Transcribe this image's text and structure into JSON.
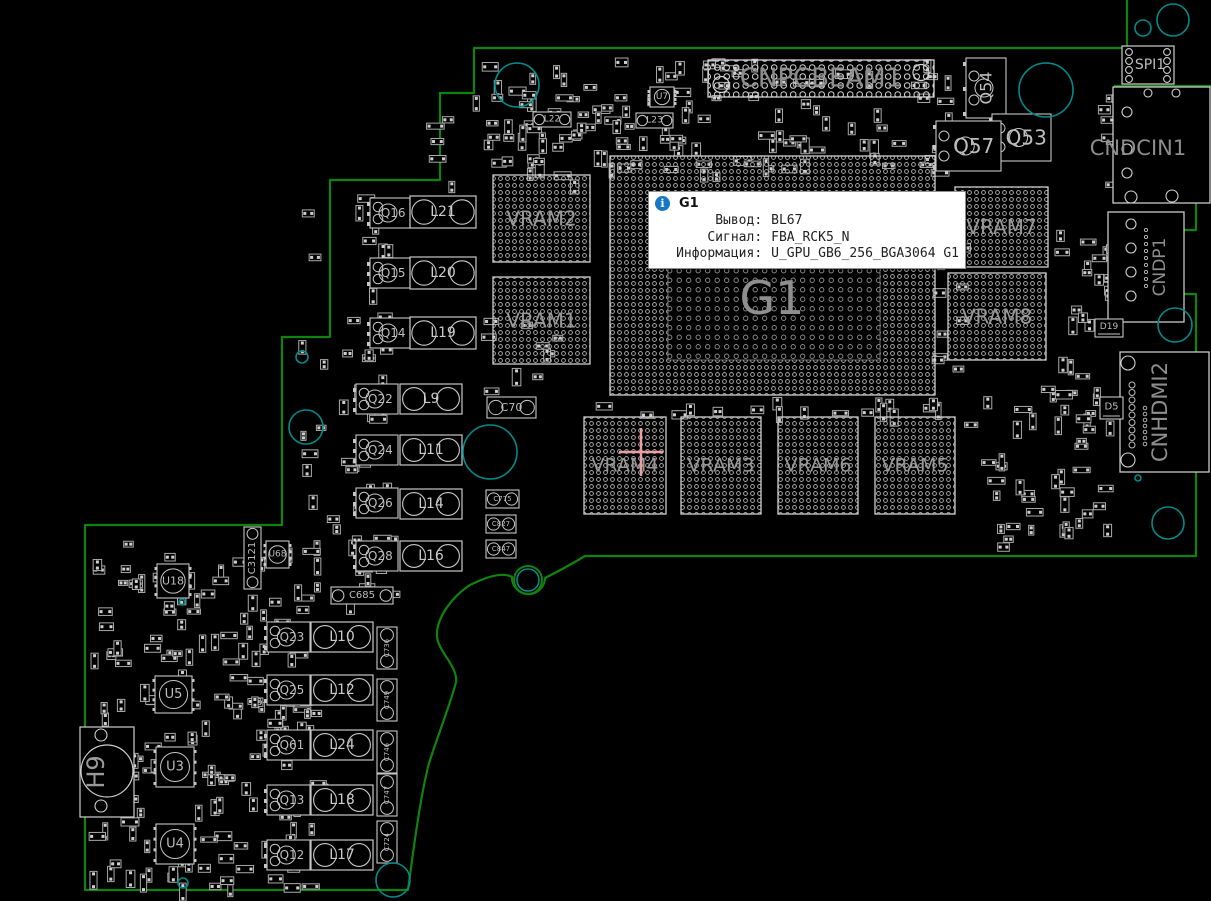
{
  "colors": {
    "background": "#000000",
    "board_outline": "#0e840e",
    "mounting_hole": "#008b8b",
    "component_stroke": "#c6c6c6",
    "pad_dot": "#bdbdbd",
    "label_big": "#8a8a8a",
    "label_small": "#bdbdbd",
    "crosshair": "#e8a0a0",
    "tooltip_icon_bg": "#1777c4"
  },
  "tooltip": {
    "title": "G1",
    "icon": "info-icon",
    "rows": [
      {
        "label": "Вывод:",
        "value": "BL67"
      },
      {
        "label": "Сигнал:",
        "value": "FBA_RCK5_N"
      },
      {
        "label": "Информация:",
        "value": "U_GPU_GB6_256_BGA3064 G1"
      }
    ]
  },
  "crosshair": {
    "x": 641,
    "y": 452,
    "arm_h": 22,
    "arm_v": 24
  },
  "board": {
    "outline_path": "M1127,0 L1127,48 L474,48 L474,93 L440,93 L440,180 L330,180 L330,337 L282,337 L282,525 L85,525 L85,890 L408,890 C414,845 420,800 428,767 C433,748 452,700 456,682 C458,666 438,652 437,636 C436,620 450,598 470,585 Q500,570 512,577 A15,15 0 1 0 545,578 Q565,568 585,556 L1196,556 L1196,294 L1150,294 L1150,230 L1196,230 L1196,186 L1115,186 L1115,86 L1211,86",
    "hdmi_cutout": {
      "x": 1141,
      "y": 357,
      "w": 33,
      "h": 112,
      "rx": 9
    },
    "edge_notch_circle": {
      "x": 528,
      "y": 580,
      "r": 14
    }
  },
  "holes": [
    {
      "x": 517,
      "y": 85,
      "r": 22
    },
    {
      "x": 1046,
      "y": 90,
      "r": 27
    },
    {
      "x": 1173,
      "y": 20,
      "r": 16
    },
    {
      "x": 1143,
      "y": 28,
      "r": 8
    },
    {
      "x": 490,
      "y": 452,
      "r": 27
    },
    {
      "x": 306,
      "y": 427,
      "r": 17
    },
    {
      "x": 302,
      "y": 357,
      "r": 6
    },
    {
      "x": 528,
      "y": 580,
      "r": 11
    },
    {
      "x": 393,
      "y": 880,
      "r": 17
    },
    {
      "x": 1175,
      "y": 325,
      "r": 17
    },
    {
      "x": 1168,
      "y": 523,
      "r": 16
    },
    {
      "x": 183,
      "y": 883,
      "r": 5
    },
    {
      "x": 182,
      "y": 602,
      "r": 3
    },
    {
      "x": 1138,
      "y": 478,
      "r": 3
    }
  ],
  "components": [
    {
      "ref": "G1",
      "type": "bga",
      "x": 610,
      "y": 156,
      "w": 325,
      "h": 239,
      "ls": 46,
      "inner": true
    },
    {
      "ref": "VRAM2",
      "type": "bga",
      "x": 493,
      "y": 175,
      "w": 97,
      "h": 87,
      "ls": 20
    },
    {
      "ref": "VRAM1",
      "type": "bga",
      "x": 493,
      "y": 277,
      "w": 97,
      "h": 87,
      "ls": 20
    },
    {
      "ref": "VRAM7",
      "type": "bga",
      "x": 955,
      "y": 187,
      "w": 93,
      "h": 80,
      "ls": 20
    },
    {
      "ref": "VRAM8",
      "type": "bga",
      "x": 948,
      "y": 273,
      "w": 98,
      "h": 87,
      "ls": 20
    },
    {
      "ref": "VRAM4",
      "type": "bga",
      "x": 584,
      "y": 417,
      "w": 82,
      "h": 97,
      "ls": 19
    },
    {
      "ref": "VRAM3",
      "type": "bga",
      "x": 681,
      "y": 417,
      "w": 80,
      "h": 97,
      "ls": 19
    },
    {
      "ref": "VRAM6",
      "type": "bga",
      "x": 778,
      "y": 417,
      "w": 80,
      "h": 97,
      "ls": 19
    },
    {
      "ref": "VRAM5",
      "type": "bga",
      "x": 875,
      "y": 417,
      "w": 80,
      "h": 97,
      "ls": 19
    },
    {
      "ref": "CNPCBEAM1",
      "type": "conn_grid",
      "x": 708,
      "y": 60,
      "w": 226,
      "h": 37,
      "ls": 26
    },
    {
      "ref": "SPI1",
      "type": "chip_pins",
      "x": 1122,
      "y": 46,
      "w": 52,
      "h": 38,
      "ls": 14
    },
    {
      "ref": "CNDCIN1",
      "type": "conn_edge",
      "x": 1113,
      "y": 87,
      "w": 97,
      "h": 116,
      "ls": 21,
      "lx": 1138,
      "ly": 148
    },
    {
      "ref": "CNDP1",
      "type": "conn_edge",
      "x": 1108,
      "y": 212,
      "w": 76,
      "h": 110,
      "ls": 17,
      "rot": true,
      "lx": 1160,
      "ly": 267
    },
    {
      "ref": "CNHDMI2",
      "type": "conn_edge",
      "x": 1120,
      "y": 352,
      "w": 89,
      "h": 120,
      "ls": 21,
      "rot": true,
      "lx": 1160,
      "ly": 412
    },
    {
      "ref": "H9",
      "type": "header",
      "x": 80,
      "y": 727,
      "w": 54,
      "h": 90,
      "ls": 24,
      "rot": true,
      "lx": 96,
      "ly": 772
    },
    {
      "ref": "Q16",
      "type": "mosfet",
      "x": 370,
      "y": 198,
      "w": 40,
      "h": 30,
      "ls": 12
    },
    {
      "ref": "L21",
      "type": "inductor",
      "x": 410,
      "y": 196,
      "w": 66,
      "h": 32,
      "ls": 14
    },
    {
      "ref": "Q15",
      "type": "mosfet",
      "x": 370,
      "y": 258,
      "w": 40,
      "h": 30,
      "ls": 12
    },
    {
      "ref": "L20",
      "type": "inductor",
      "x": 410,
      "y": 257,
      "w": 66,
      "h": 32,
      "ls": 14
    },
    {
      "ref": "Q14",
      "type": "mosfet",
      "x": 370,
      "y": 318,
      "w": 40,
      "h": 30,
      "ls": 12
    },
    {
      "ref": "L19",
      "type": "inductor",
      "x": 410,
      "y": 317,
      "w": 66,
      "h": 32,
      "ls": 14
    },
    {
      "ref": "Q22",
      "type": "mosfet",
      "x": 356,
      "y": 384,
      "w": 42,
      "h": 30,
      "ls": 12
    },
    {
      "ref": "L9",
      "type": "inductor",
      "x": 400,
      "y": 384,
      "w": 62,
      "h": 30,
      "ls": 14
    },
    {
      "ref": "Q24",
      "type": "mosfet",
      "x": 356,
      "y": 435,
      "w": 42,
      "h": 30,
      "ls": 12
    },
    {
      "ref": "L11",
      "type": "inductor",
      "x": 400,
      "y": 435,
      "w": 62,
      "h": 30,
      "ls": 14
    },
    {
      "ref": "Q26",
      "type": "mosfet",
      "x": 356,
      "y": 488,
      "w": 42,
      "h": 30,
      "ls": 12
    },
    {
      "ref": "L14",
      "type": "inductor",
      "x": 400,
      "y": 489,
      "w": 62,
      "h": 30,
      "ls": 14
    },
    {
      "ref": "Q28",
      "type": "mosfet",
      "x": 356,
      "y": 541,
      "w": 42,
      "h": 30,
      "ls": 12
    },
    {
      "ref": "L16",
      "type": "inductor",
      "x": 400,
      "y": 541,
      "w": 62,
      "h": 30,
      "ls": 14
    },
    {
      "ref": "Q23",
      "type": "mosfet",
      "x": 267,
      "y": 622,
      "w": 43,
      "h": 30,
      "ls": 12
    },
    {
      "ref": "L10",
      "type": "inductor",
      "x": 311,
      "y": 622,
      "w": 62,
      "h": 30,
      "ls": 14
    },
    {
      "ref": "Q25",
      "type": "mosfet",
      "x": 267,
      "y": 675,
      "w": 43,
      "h": 30,
      "ls": 12
    },
    {
      "ref": "L12",
      "type": "inductor",
      "x": 311,
      "y": 675,
      "w": 62,
      "h": 30,
      "ls": 14
    },
    {
      "ref": "Q61",
      "type": "mosfet",
      "x": 267,
      "y": 730,
      "w": 43,
      "h": 30,
      "ls": 12
    },
    {
      "ref": "L24",
      "type": "inductor",
      "x": 311,
      "y": 730,
      "w": 62,
      "h": 30,
      "ls": 14
    },
    {
      "ref": "Q13",
      "type": "mosfet",
      "x": 267,
      "y": 785,
      "w": 43,
      "h": 30,
      "ls": 12
    },
    {
      "ref": "L18",
      "type": "inductor",
      "x": 311,
      "y": 785,
      "w": 62,
      "h": 30,
      "ls": 14
    },
    {
      "ref": "Q12",
      "type": "mosfet",
      "x": 267,
      "y": 840,
      "w": 43,
      "h": 30,
      "ls": 12
    },
    {
      "ref": "L17",
      "type": "inductor",
      "x": 311,
      "y": 840,
      "w": 62,
      "h": 30,
      "ls": 14
    },
    {
      "ref": "Q54",
      "type": "mosfet",
      "x": 966,
      "y": 58,
      "w": 40,
      "h": 60,
      "ls": 16,
      "rot": true
    },
    {
      "ref": "Q53",
      "type": "mosfet",
      "x": 992,
      "y": 114,
      "w": 59,
      "h": 47,
      "ls": 20
    },
    {
      "ref": "Q57",
      "type": "mosfet",
      "x": 936,
      "y": 121,
      "w": 65,
      "h": 50,
      "ls": 20
    },
    {
      "ref": "U5",
      "type": "qfn",
      "x": 155,
      "y": 676,
      "w": 37,
      "h": 37,
      "ls": 13
    },
    {
      "ref": "U3",
      "type": "qfn",
      "x": 156,
      "y": 747,
      "w": 38,
      "h": 40,
      "ls": 13
    },
    {
      "ref": "U4",
      "type": "qfn",
      "x": 156,
      "y": 824,
      "w": 38,
      "h": 40,
      "ls": 13
    },
    {
      "ref": "U18",
      "type": "qfn",
      "x": 157,
      "y": 564,
      "w": 32,
      "h": 34,
      "ls": 11
    },
    {
      "ref": "U68",
      "type": "qfn",
      "x": 266,
      "y": 541,
      "w": 23,
      "h": 27,
      "ls": 9
    },
    {
      "ref": "U7",
      "type": "qfn",
      "x": 650,
      "y": 87,
      "w": 24,
      "h": 20,
      "ls": 9
    },
    {
      "ref": "C70",
      "type": "cap_h",
      "x": 487,
      "y": 397,
      "w": 49,
      "h": 21,
      "ls": 11
    },
    {
      "ref": "C685",
      "type": "cap_h",
      "x": 331,
      "y": 587,
      "w": 62,
      "h": 17,
      "ls": 10
    },
    {
      "ref": "L22",
      "type": "cap_h",
      "x": 533,
      "y": 112,
      "w": 38,
      "h": 15,
      "ls": 9
    },
    {
      "ref": "L23",
      "type": "cap_h",
      "x": 636,
      "y": 113,
      "w": 37,
      "h": 15,
      "ls": 9
    },
    {
      "ref": "C3121",
      "type": "cap_v",
      "x": 244,
      "y": 527,
      "w": 17,
      "h": 62,
      "ls": 10
    },
    {
      "ref": "C736",
      "type": "cap_v",
      "x": 377,
      "y": 627,
      "w": 20,
      "h": 42,
      "ls": 7
    },
    {
      "ref": "C749",
      "type": "cap_v",
      "x": 377,
      "y": 679,
      "w": 20,
      "h": 42,
      "ls": 7
    },
    {
      "ref": "C746",
      "type": "cap_v",
      "x": 377,
      "y": 731,
      "w": 20,
      "h": 42,
      "ls": 7
    },
    {
      "ref": "C747",
      "type": "cap_v",
      "x": 377,
      "y": 774,
      "w": 20,
      "h": 42,
      "ls": 7
    },
    {
      "ref": "C724",
      "type": "cap_v",
      "x": 377,
      "y": 821,
      "w": 20,
      "h": 42,
      "ls": 7
    },
    {
      "ref": "C775",
      "type": "cap_h",
      "x": 486,
      "y": 490,
      "w": 33,
      "h": 18,
      "ls": 7
    },
    {
      "ref": "C827",
      "type": "cap_h",
      "x": 486,
      "y": 515,
      "w": 30,
      "h": 18,
      "ls": 7
    },
    {
      "ref": "C847",
      "type": "cap_h",
      "x": 486,
      "y": 540,
      "w": 30,
      "h": 18,
      "ls": 7
    },
    {
      "ref": "D19",
      "type": "diode",
      "x": 1095,
      "y": 319,
      "w": 28,
      "h": 18,
      "ls": 9
    },
    {
      "ref": "D5",
      "type": "diode",
      "x": 1100,
      "y": 397,
      "w": 23,
      "h": 22,
      "ls": 10
    }
  ]
}
